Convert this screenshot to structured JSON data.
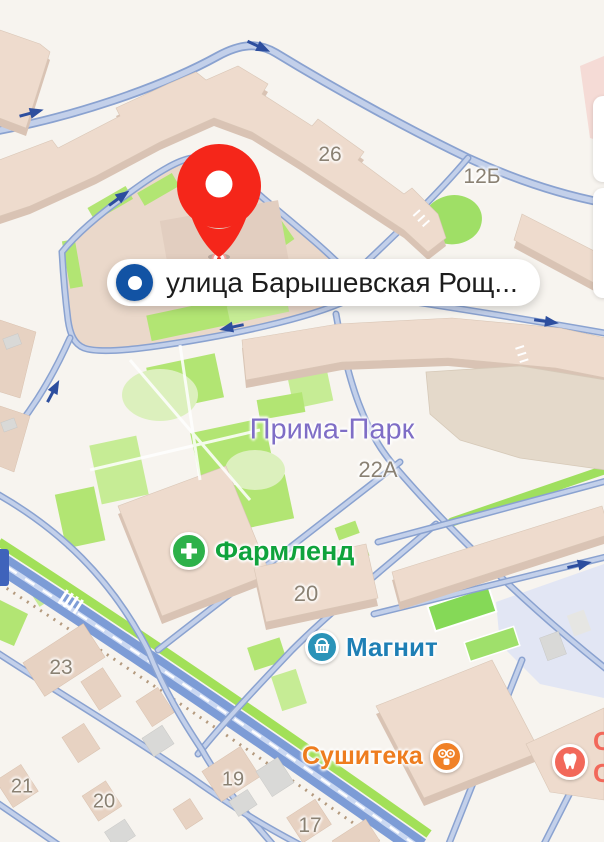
{
  "map": {
    "search_result": {
      "text": "улица Барышевская Рощ..."
    },
    "pin": {
      "color": "#f5261a"
    },
    "district_label": {
      "text": "Прима-Парк",
      "color": "#7f6ec6"
    },
    "building_numbers": [
      {
        "text": "26"
      },
      {
        "text": "12Б"
      },
      {
        "text": "22А"
      },
      {
        "text": "20"
      },
      {
        "text": "23"
      },
      {
        "text": "21"
      },
      {
        "text": "20"
      },
      {
        "text": "19"
      },
      {
        "text": "17"
      }
    ],
    "pois": [
      {
        "name": "Фармленд",
        "category": "pharmacy",
        "color": "#0fa33c",
        "icon": "plus-icon"
      },
      {
        "name": "Магнит",
        "category": "supermarket",
        "color": "#1e7fb5",
        "icon": "basket-icon"
      },
      {
        "name": "Сушитека",
        "category": "restaurant",
        "color": "#ee7d1f",
        "icon": "sushi-icon"
      },
      {
        "name": "",
        "category": "dentist",
        "color": "#f2685a",
        "icon": "tooth-icon"
      }
    ],
    "edge_cut_text": [
      "С",
      "С"
    ],
    "colors": {
      "background": "#f7f4ef",
      "road_casing": "#8aa2d0",
      "road_fill": "#c3d0ea",
      "highway": "#7d9cd6",
      "green": "#b2e573",
      "building_roof": "#eedbcd",
      "building_side": "#d9c3b4",
      "accent_blue": "#1253a4",
      "pin_red": "#f5261a"
    }
  }
}
